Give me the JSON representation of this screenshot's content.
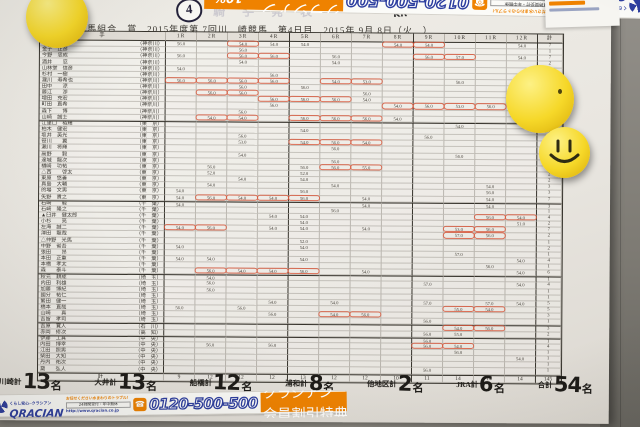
{
  "header": {
    "race_mark": "4",
    "bleed_text": "騎手発表",
    "scribble": "KR",
    "title": "川崎競馬組合　賞　2015年度第 7回川　崎競馬　第4日目　2015年 9月 8日（火　）"
  },
  "banner": {
    "tagline": "くらし安心─クラシアン",
    "brand": "QRACIAN",
    "offer_line1": "お任せください水まわりのトラブル！",
    "offer_line2": "24時間受付・年中無休",
    "url": "http://www.qracian.co.jp",
    "tel_icon": "☎",
    "phone": "0120-500-500",
    "promo_name": "クラシアン",
    "promo_text": "会員割引特典",
    "promo_pct": "10%",
    "promo_off": "OFF",
    "accent_blue": "#2d3e9f",
    "accent_orange": "#ef8200"
  },
  "table": {
    "corner_label": "手",
    "columns": [
      "1R",
      "2R",
      "3R",
      "4R",
      "5R",
      "6R",
      "7R",
      "8R",
      "9R",
      "10R",
      "11R",
      "12R",
      "計"
    ],
    "group_starts": [
      13,
      26,
      38,
      46,
      48
    ],
    "rows": [
      {
        "n": "　　　聡人",
        "a": "神奈川",
        "v": {
          "0": "56.0",
          "2": "54.0",
          "3": "54.0",
          "4": "54.0",
          "7": "54.0",
          "8": "54.0",
          "11": "54.0"
        },
        "c": [
          2,
          7,
          8
        ],
        "t": "7"
      },
      {
        "n": "金子　正彦",
        "a": "神奈川",
        "v": {
          "2": "56.0"
        },
        "c": [],
        "t": "1"
      },
      {
        "n": "今野　忠成",
        "a": "神奈川",
        "v": {
          "0": "56.0",
          "2": "56.0",
          "3": "56.0",
          "5": "56.0",
          "8": "56.0",
          "9": "57.0",
          "11": "54.0"
        },
        "c": [
          2,
          3,
          8,
          9
        ],
        "t": "7"
      },
      {
        "n": "酒井　　忍",
        "a": "神奈川",
        "v": {
          "2": "54.0",
          "5": "54.0"
        },
        "c": [],
        "t": "2"
      },
      {
        "n": "山林堂　信彦",
        "a": "神奈川",
        "v": {
          "0": "54.0"
        },
        "c": [],
        "t": "1"
      },
      {
        "n": "杉村　一樹",
        "a": "神奈川",
        "v": {
          "3": "56.0",
          "11": "54.0"
        },
        "c": [],
        "t": "2"
      },
      {
        "n": "瀧川　寿希也",
        "a": "神奈川",
        "v": {
          "0": "56.0",
          "1": "56.0",
          "2": "56.0",
          "3": "56.0",
          "5": "54.0",
          "6": "53.0",
          "9": "56.0"
        },
        "c": [
          0,
          1,
          2,
          3,
          5,
          6
        ],
        "t": "7"
      },
      {
        "n": "田中　　涼",
        "a": "神奈川",
        "v": {
          "2": "56.0",
          "4": "56.0"
        },
        "c": [],
        "t": "2"
      },
      {
        "n": "藤江　　渉",
        "a": "神奈川",
        "v": {
          "1": "56.0",
          "2": "56.0",
          "6": "56.0"
        },
        "c": [
          1,
          2
        ],
        "t": "3"
      },
      {
        "n": "増田　充宏",
        "a": "神奈川",
        "v": {
          "3": "56.0",
          "4": "56.0",
          "5": "56.0",
          "6": "54.0"
        },
        "c": [
          3,
          4,
          5
        ],
        "t": "4"
      },
      {
        "n": "町田　直希",
        "a": "神奈川",
        "v": {
          "3": "56.0",
          "7": "54.0",
          "8": "56.0",
          "9": "53.0",
          "10": "56.0",
          "11": "54.0"
        },
        "c": [
          7,
          8,
          9,
          10
        ],
        "t": "6"
      },
      {
        "n": "森下　　博",
        "a": "神奈川",
        "v": {
          "2": "56.0"
        },
        "c": [],
        "t": "1"
      },
      {
        "n": "山崎　誠士",
        "a": "神奈川",
        "v": {
          "1": "54.0",
          "2": "54.0",
          "4": "56.0",
          "5": "56.0",
          "6": "56.0",
          "7": "54.0",
          "11": "54.0"
        },
        "c": [
          1,
          2,
          4,
          5,
          6
        ],
        "t": "7"
      },
      {
        "n": "江里口　裕輝",
        "a": "東　京",
        "v": {
          "9": "54.0"
        },
        "c": [],
        "t": "1"
      },
      {
        "n": "柏木　健宏",
        "a": "東　京",
        "v": {
          "4": "54.0"
        },
        "c": [],
        "t": "1"
      },
      {
        "n": "坂井　英光",
        "a": "東　京",
        "v": {
          "2": "56.0",
          "8": "56.0"
        },
        "c": [],
        "t": "2"
      },
      {
        "n": "笹川　　翼",
        "a": "東　京",
        "v": {
          "2": "53.0",
          "4": "54.0",
          "5": "56.0",
          "6": "54.0"
        },
        "c": [
          4,
          5,
          6
        ],
        "t": "4"
      },
      {
        "n": "瀬川　将輝",
        "a": "東　京",
        "v": {
          "5": "56.0"
        },
        "c": [],
        "t": "1"
      },
      {
        "n": "高野　　毅",
        "a": "東　京",
        "v": {
          "2": "54.0",
          "9": "56.0"
        },
        "c": [],
        "t": "2"
      },
      {
        "n": "達城　龍次",
        "a": "東　京",
        "v": {
          "5": "56.0"
        },
        "c": [],
        "t": "1"
      },
      {
        "n": "楢崎　功祐",
        "a": "東　京",
        "v": {
          "1": "56.0",
          "4": "56.0",
          "5": "56.0",
          "6": "55.0"
        },
        "c": [
          5,
          6
        ],
        "t": "4"
      },
      {
        "n": "△西　　啓太",
        "a": "東　京",
        "v": {
          "1": "52.0",
          "4": "52.0"
        },
        "c": [],
        "t": "2"
      },
      {
        "n": "東原　悠善",
        "a": "東　京",
        "v": {
          "2": "54.0",
          "4": "54.0"
        },
        "c": [],
        "t": "2"
      },
      {
        "n": "真島　大輔",
        "a": "東　京",
        "v": {
          "1": "54.0",
          "5": "54.0",
          "10": "54.0"
        },
        "c": [],
        "t": "3"
      },
      {
        "n": "的場　文男",
        "a": "東　京",
        "v": {
          "0": "54.0",
          "4": "56.0",
          "10": "56.0"
        },
        "c": [],
        "t": "3"
      },
      {
        "n": "矢野　貴之",
        "a": "東　京",
        "v": {
          "0": "54.0",
          "1": "56.0",
          "2": "54.0",
          "3": "54.0",
          "4": "56.0",
          "6": "54.0",
          "10": "54.0"
        },
        "c": [
          1,
          2,
          3,
          4
        ],
        "t": "7"
      },
      {
        "n": "石崎　　駿",
        "a": "千　葉",
        "v": {
          "0": "54.0",
          "6": "54.0",
          "10": "54.0"
        },
        "c": [],
        "t": "3"
      },
      {
        "n": "石崎　隆之",
        "a": "千　葉",
        "v": {
          "5": "56.0"
        },
        "c": [],
        "t": "1"
      },
      {
        "n": "▲臼井　健太郎",
        "a": "千　葉",
        "v": {
          "3": "54.0",
          "4": "54.0",
          "10": "56.0",
          "11": "54.0"
        },
        "c": [
          10,
          11
        ],
        "t": "4"
      },
      {
        "n": "小杉　　亮",
        "a": "千　葉",
        "v": {
          "4": "54.0",
          "11": "51.0"
        },
        "c": [],
        "t": "2"
      },
      {
        "n": "左海　誠二",
        "a": "千　葉",
        "v": {
          "0": "54.0",
          "1": "56.0",
          "3": "54.0",
          "4": "54.0",
          "6": "54.0",
          "9": "53.0",
          "10": "56.0"
        },
        "c": [
          0,
          1,
          9,
          10
        ],
        "t": "7"
      },
      {
        "n": "澤田　龍哉",
        "a": "千　葉",
        "v": {
          "9": "57.0",
          "10": "56.0"
        },
        "c": [
          9,
          10
        ],
        "t": "2"
      },
      {
        "n": "△仲野　光馬",
        "a": "千　葉",
        "v": {
          "4": "52.0"
        },
        "c": [],
        "t": "1"
      },
      {
        "n": "中野　省吾",
        "a": "千　葉",
        "v": {
          "0": "54.0",
          "4": "54.0"
        },
        "c": [],
        "t": "2"
      },
      {
        "n": "張田　　昂",
        "a": "千　葉",
        "v": {
          "9": "57.0"
        },
        "c": [],
        "t": "1"
      },
      {
        "n": "本田　正重",
        "a": "千　葉",
        "v": {
          "0": "54.0",
          "1": "54.0",
          "4": "54.0",
          "11": "54.0"
        },
        "c": [],
        "t": "4"
      },
      {
        "n": "本橋　孝太",
        "a": "千　葉",
        "v": {
          "10": "56.0"
        },
        "c": [],
        "t": "1"
      },
      {
        "n": "森　　泰斗",
        "a": "千　葉",
        "v": {
          "1": "56.0",
          "2": "54.0",
          "3": "54.0",
          "4": "56.0",
          "6": "54.0",
          "11": "54.0"
        },
        "c": [
          1,
          2,
          3,
          4
        ],
        "t": "6"
      },
      {
        "n": "秋元　耕成",
        "a": "埼　玉",
        "v": {
          "1": "54.0"
        },
        "c": [],
        "t": "1"
      },
      {
        "n": "内田　利雄",
        "a": "埼　玉",
        "v": {
          "1": "56.0",
          "8": "57.0",
          "11": "54.0"
        },
        "c": [],
        "t": "4"
      },
      {
        "n": "加藤　博紀",
        "a": "埼　玉",
        "v": {
          "1": "56.0"
        },
        "c": [],
        "t": "1"
      },
      {
        "n": "國分　祐仁",
        "a": "埼　玉",
        "v": {},
        "c": [],
        "t": "1"
      },
      {
        "n": "繁田　健一",
        "a": "埼　玉",
        "v": {
          "3": "54.0",
          "5": "54.0",
          "8": "57.0",
          "10": "57.0",
          "11": "54.0"
        },
        "c": [],
        "t": "5"
      },
      {
        "n": "橋本　直哉",
        "a": "埼　玉",
        "v": {
          "0": "56.0",
          "2": "56.0",
          "9": "55.0",
          "10": "54.0"
        },
        "c": [
          9,
          10
        ],
        "t": "5"
      },
      {
        "n": "山崎　　真",
        "a": "埼　玉",
        "v": {
          "3": "56.0",
          "5": "54.0",
          "6": "56.0"
        },
        "c": [
          5,
          6
        ],
        "t": "3"
      },
      {
        "n": "吉留　孝司",
        "a": "埼　玉",
        "v": {
          "8": "56.0"
        },
        "c": [],
        "t": "1"
      },
      {
        "n": "吉原　寛人",
        "a": "石　川",
        "v": {
          "9": "54.0",
          "10": "56.0"
        },
        "c": [
          9,
          10
        ],
        "t": "3"
      },
      {
        "n": "赤岡　修次",
        "a": "高　知",
        "v": {
          "8": "56.0",
          "9": "55.0"
        },
        "c": [],
        "t": "2"
      },
      {
        "n": "伊藤　工真",
        "a": "中　央",
        "v": {
          "8": "56.0"
        },
        "c": [],
        "t": "1"
      },
      {
        "n": "内田　博幸",
        "a": "中　央",
        "v": {
          "1": "56.0",
          "3": "56.0",
          "8": "56.0",
          "9": "54.0"
        },
        "c": [
          8,
          9
        ],
        "t": "4"
      },
      {
        "n": "江田　照男",
        "a": "中　央",
        "v": {
          "9": "56.0"
        },
        "c": [],
        "t": "1"
      },
      {
        "n": "柴田　大知",
        "a": "中　央",
        "v": {
          "11": "54.0"
        },
        "c": [],
        "t": "1"
      },
      {
        "n": "丹内　祐次",
        "a": "中　央",
        "v": {},
        "c": [],
        "t": "1"
      },
      {
        "n": "黛　　弘人",
        "a": "中　央",
        "v": {
          "8": "56.0"
        },
        "c": [],
        "t": "1"
      }
    ],
    "footer_label": "計",
    "footer": [
      "9",
      "12",
      "12",
      "12",
      "13",
      "12",
      "12",
      "10",
      "11",
      "14",
      "14",
      "14",
      "145"
    ]
  },
  "totals": [
    {
      "label": "川崎計",
      "num": "13",
      "suffix": "名"
    },
    {
      "label": "大井計",
      "num": "13",
      "suffix": "名"
    },
    {
      "label": "船橋計",
      "num": "12",
      "suffix": "名"
    },
    {
      "label": "浦和計",
      "num": "8",
      "suffix": "名"
    },
    {
      "label": "他地区計",
      "num": "2",
      "suffix": "名"
    },
    {
      "label": "JRA計",
      "num": "6",
      "suffix": "名"
    },
    {
      "label": "合計",
      "num": "54",
      "suffix": "名"
    }
  ],
  "magnets": {
    "color": "#f6d829",
    "count": 3,
    "smiley": "smiley-face"
  }
}
